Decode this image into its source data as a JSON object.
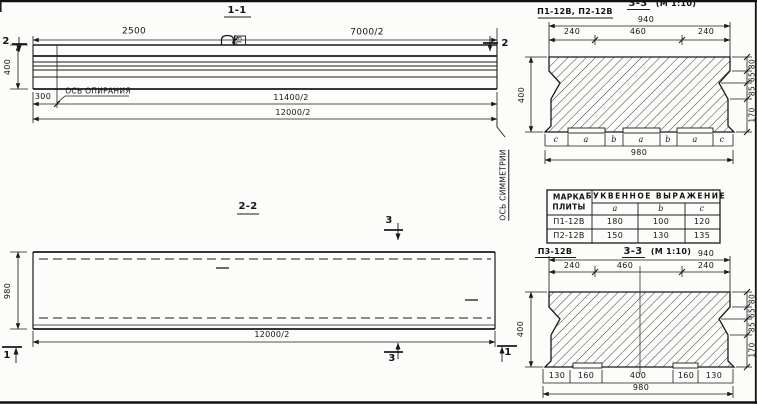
{
  "s11": {
    "title": "1-1",
    "d2500": "2500",
    "d7000": "7000/2",
    "d400": "400",
    "d300": "300",
    "d11400": "11400/2",
    "d12000": "12000/2",
    "support_axis": "ОСЬ ОПИРАНИЯ",
    "loop": "ПЗ",
    "cut": "2"
  },
  "s22": {
    "title": "2-2",
    "d980": "980",
    "d12000": "12000/2",
    "cut3": "3",
    "cut1": "1"
  },
  "sym": "ОСЬ СИММЕТРИИ",
  "cst": {
    "label": "П1-12В, П2-12В",
    "title": "3-3",
    "scale": "(М 1:10)",
    "d940": "940",
    "dtop": [
      "240",
      "460",
      "240"
    ],
    "dright": [
      "80",
      "65",
      "85",
      "170"
    ],
    "d400": "400",
    "letters": [
      "c",
      "a",
      "b",
      "a",
      "b",
      "a",
      "c"
    ],
    "d980": "980"
  },
  "tbl": {
    "h1a": "МАРКА",
    "h1b": "ПЛИТЫ",
    "h2": "БУКВЕННОЕ  ВЫРАЖЕНИЕ",
    "sub": [
      "a",
      "b",
      "c"
    ],
    "rows": [
      [
        "П1-12В",
        "180",
        "100",
        "120"
      ],
      [
        "П2-12В",
        "150",
        "130",
        "135"
      ]
    ]
  },
  "csb": {
    "label": "П3-12В",
    "title": "3-3",
    "scale": "(М 1:10)",
    "d940": "940",
    "dtop": [
      "240",
      "460",
      "240"
    ],
    "dright": [
      "80",
      "65",
      "85",
      "170"
    ],
    "d400": "400",
    "dbottom": [
      "130",
      "160",
      "400",
      "160",
      "130"
    ],
    "d980": "980"
  }
}
